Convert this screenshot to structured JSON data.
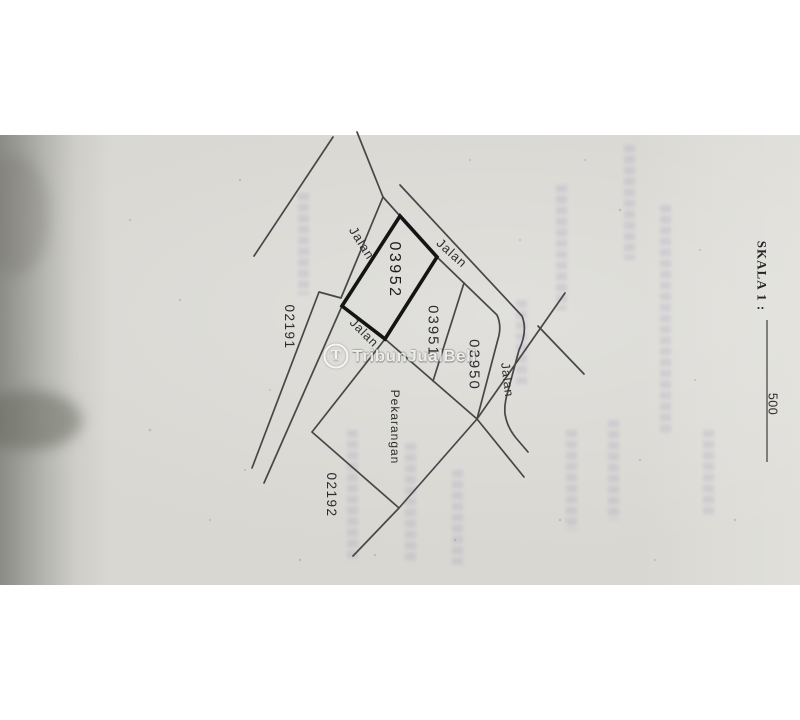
{
  "map": {
    "road_label": "Jalan",
    "parcels": [
      {
        "id": "03952",
        "highlighted": true
      },
      {
        "id": "03951",
        "highlighted": false
      },
      {
        "id": "03950",
        "highlighted": false
      }
    ],
    "land_label": "Pekarangan",
    "blocks": [
      {
        "id": "02191"
      },
      {
        "id": "02192"
      }
    ],
    "scale": {
      "label": "SKALA 1 :",
      "value": "500"
    },
    "watermark": {
      "logo": "T",
      "text": "TribunJualBeli"
    },
    "colors": {
      "paper": "#d8d7d2",
      "ink": "#474747",
      "highlight_ink": "#141414"
    }
  }
}
